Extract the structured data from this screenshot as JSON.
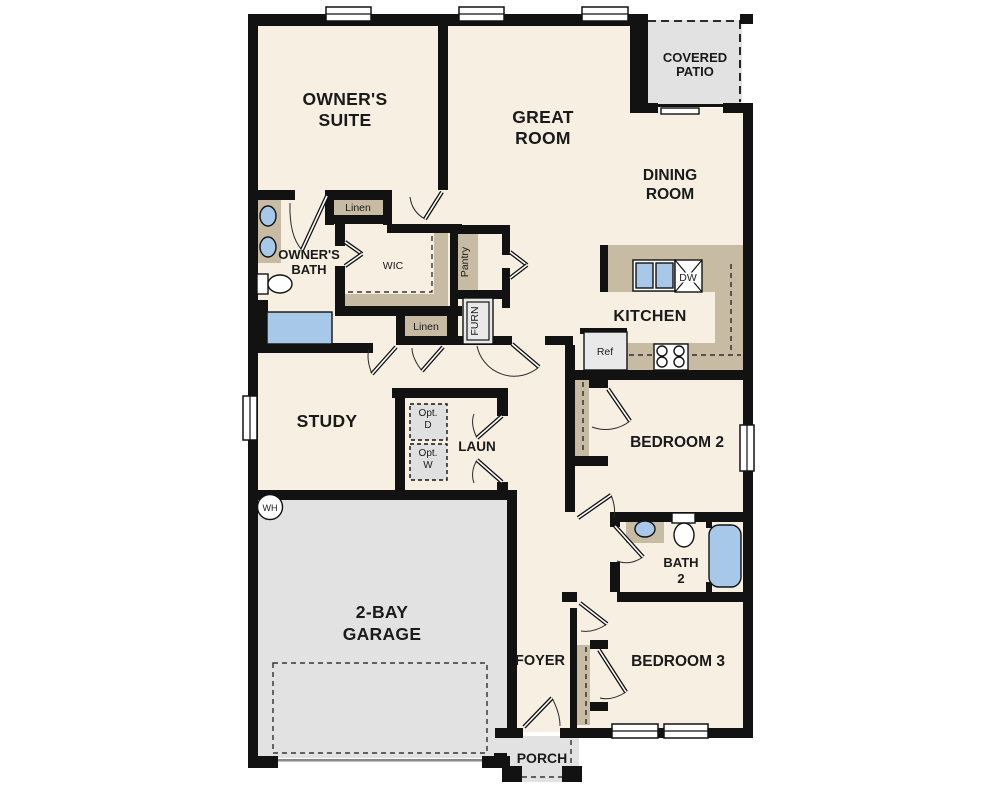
{
  "title": "floor-plan",
  "labels": {
    "owners_suite_1": "OWNER'S",
    "owners_suite_2": "SUITE",
    "great_room_1": "GREAT",
    "great_room_2": "ROOM",
    "covered_patio_1": "COVERED",
    "covered_patio_2": "PATIO",
    "dining_room_1": "DINING",
    "dining_room_2": "ROOM",
    "owners_bath_1": "OWNER'S",
    "owners_bath_2": "BATH",
    "linen_top": "Linen",
    "wic": "WIC",
    "pantry": "Pantry",
    "furnace": "FURN",
    "linen_hall": "Linen",
    "kitchen": "KITCHEN",
    "dishwasher": "DW",
    "refrigerator": "Ref",
    "study": "STUDY",
    "opt_dryer_1": "Opt.",
    "opt_dryer_2": "D",
    "opt_washer_1": "Opt.",
    "opt_washer_2": "W",
    "laundry": "LAUN",
    "bedroom2": "BEDROOM 2",
    "bath2_1": "BATH",
    "bath2_2": "2",
    "water_heater": "WH",
    "garage_1": "2-BAY",
    "garage_2": "GARAGE",
    "foyer": "FOYER",
    "bedroom3": "BEDROOM 3",
    "porch": "PORCH"
  },
  "colors": {
    "wall": "#121212",
    "floor": "#f6efe2",
    "outdoor": "#e2e2e2",
    "closet": "#c7bba4",
    "fixture_blue": "#a8c8e9"
  }
}
